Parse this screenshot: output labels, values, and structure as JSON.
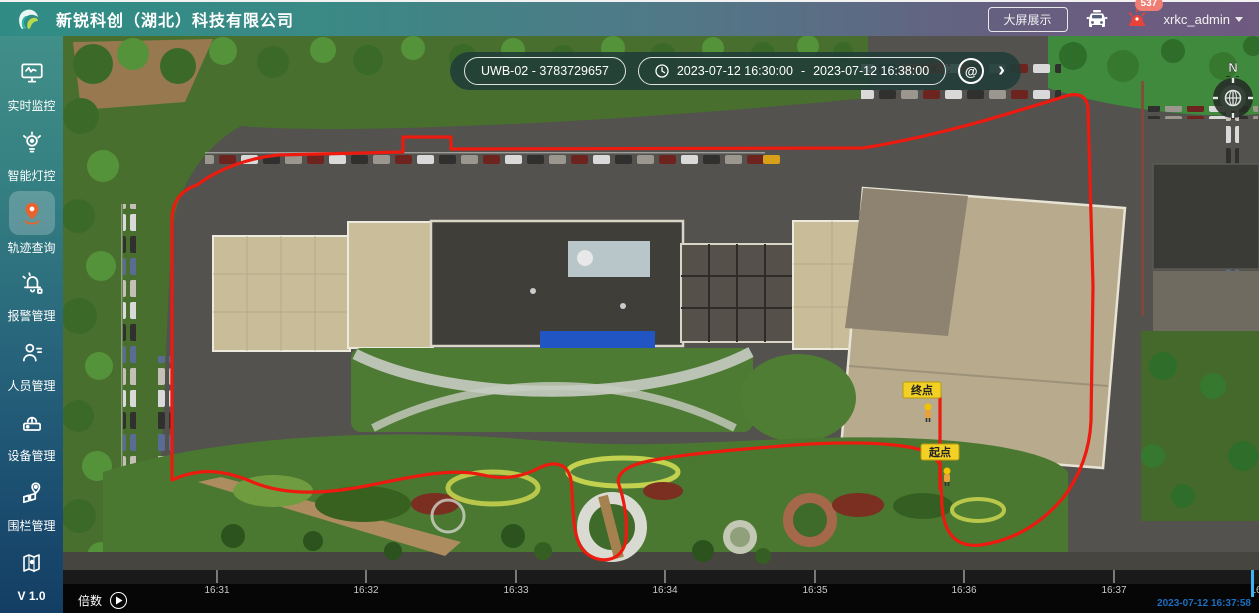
{
  "header": {
    "title": "新锐科创（湖北）科技有限公司",
    "big_screen_button": "大屏展示",
    "alarm_badge": "537",
    "username": "xrkc_admin"
  },
  "sidebar": {
    "items": [
      {
        "label": "实时监控",
        "icon": "monitor-icon",
        "active": false
      },
      {
        "label": "智能灯控",
        "icon": "smart-light-icon",
        "active": false
      },
      {
        "label": "轨迹查询",
        "icon": "trajectory-pin-icon",
        "active": true
      },
      {
        "label": "报警管理",
        "icon": "alarm-bell-icon",
        "active": false
      },
      {
        "label": "人员管理",
        "icon": "person-icon",
        "active": false
      },
      {
        "label": "设备管理",
        "icon": "device-icon",
        "active": false
      },
      {
        "label": "围栏管理",
        "icon": "fence-pin-icon",
        "active": false
      },
      {
        "label": "",
        "icon": "map-icon",
        "active": false
      }
    ],
    "version": "V 1.0"
  },
  "toolbar": {
    "device_value": "UWB-02 - 3783729657",
    "time_from": "2023-07-12 16:30:00",
    "time_separator": "-",
    "time_to": "2023-07-12 16:38:00",
    "search_glyph": "@",
    "next_glyph": "›"
  },
  "map": {
    "current_position_text": "当前位置：张三",
    "end_marker": "终点",
    "start_marker": "起点",
    "compass_label": "N"
  },
  "timeline": {
    "speed_label": "倍数",
    "ticks": [
      "16:31",
      "16:32",
      "16:33",
      "16:34",
      "16:35",
      "16:36",
      "16:37",
      "16:38"
    ],
    "current_time": "2023-07-12 16:37:58"
  },
  "colors": {
    "header_gradient_left": "#2f8c85",
    "header_gradient_right": "#6f5a80",
    "accent_orange": "#e8632c",
    "trajectory_red": "#ec1a0f",
    "marker_yellow": "#f2d024",
    "playhead_cyan": "#3fb3ef",
    "timestamp_blue": "#1b6fc2",
    "badge_pink": "#ef7d74"
  }
}
